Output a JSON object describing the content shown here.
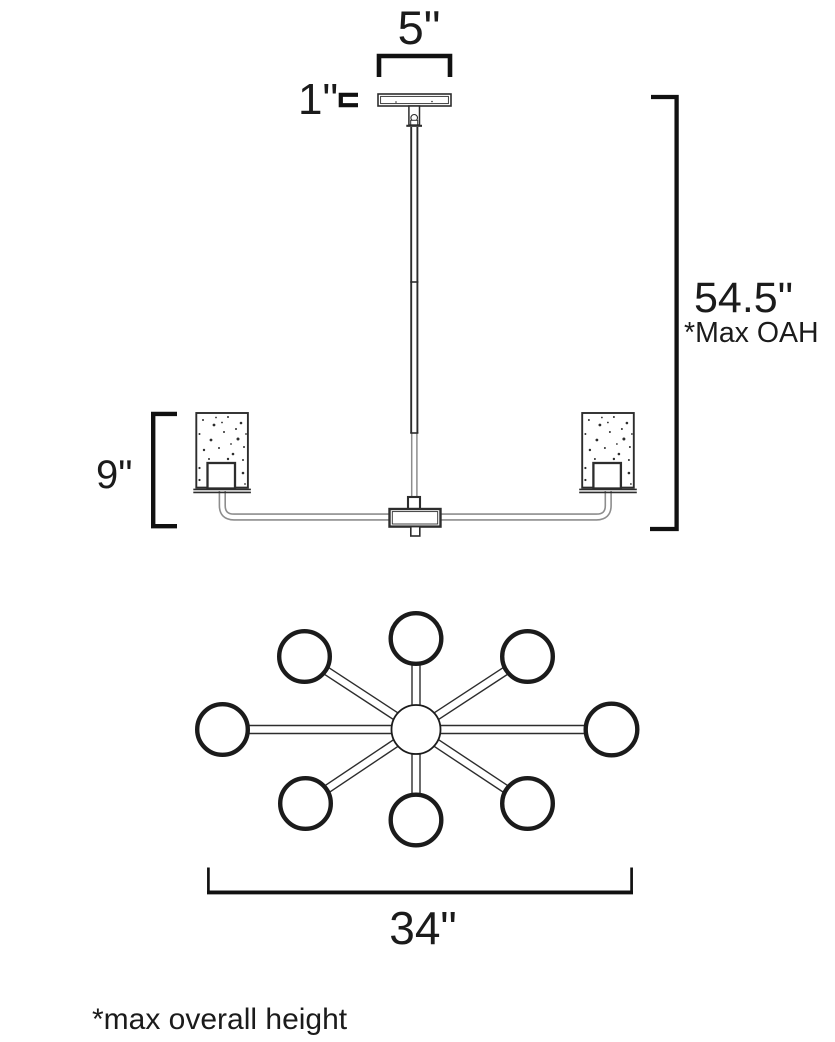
{
  "diagram": {
    "kind": "chandelier line drawing with dimensions",
    "views": {
      "elevation": "side elevation of 8-light chandelier with rod, canopy and two cylindrical shades",
      "plan": "top plan view: 8 globes on arms radiating from a central hub"
    }
  },
  "colors": {
    "line": "#1b1b1b",
    "arm_gray": "#8d8d8d",
    "background": "#ffffff"
  },
  "dimensions": {
    "canopy_width": "5\"",
    "canopy_height": "1\"",
    "max_overall_height": "54.5\"",
    "max_overall_height_note": "*Max OAH",
    "shade_height": "9\"",
    "fixture_width": "34\""
  },
  "footnote": "*max overall height"
}
